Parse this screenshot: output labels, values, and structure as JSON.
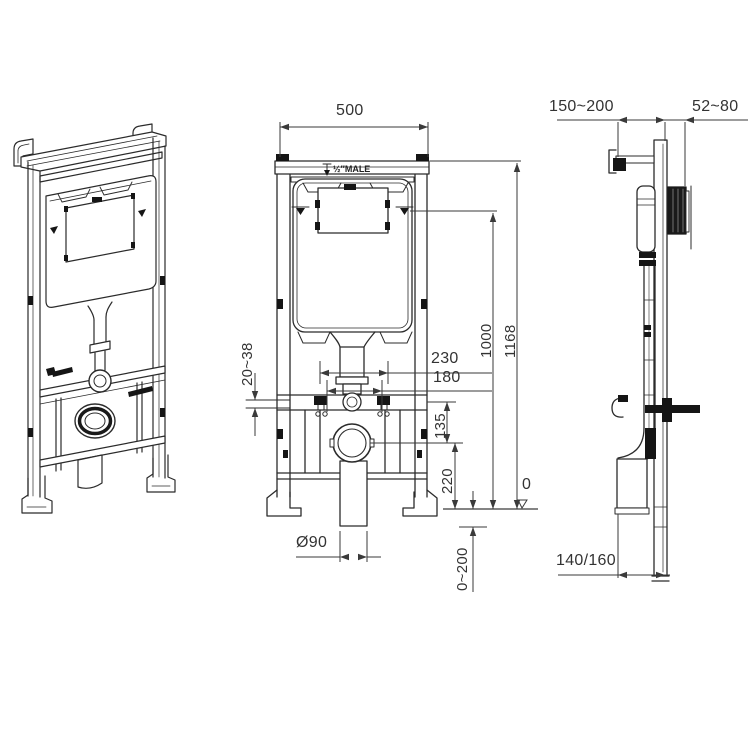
{
  "colors": {
    "background": "#ffffff",
    "line": "#2b2b2b",
    "dimension_line": "#3a3a3a",
    "text": "#333333",
    "solid_black": "#151515"
  },
  "front_view": {
    "frame_width": "500",
    "water_inlet": "½″MALE",
    "bolt_span_outer": "230",
    "bolt_span_inner": "180",
    "bracket_adjust": "20~38",
    "outlet_offset": "135",
    "outlet_height": "220",
    "flush_level_height": "1000",
    "frame_height": "1168",
    "floor_datum": "0",
    "drain_diameter": "Ø90",
    "below_floor_adjust": "0~200"
  },
  "side_view": {
    "wall_bracket_range": "150~200",
    "plate_depth_range": "52~80",
    "frame_depth": "140/160"
  }
}
